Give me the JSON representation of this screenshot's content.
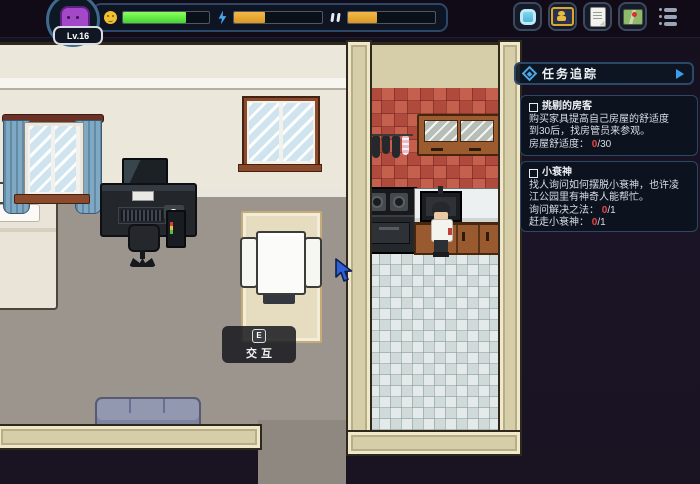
{
  "hud": {
    "avatar": {
      "level_label": "Lv.16"
    },
    "bars": {
      "mood": {
        "icon": "smiley-icon",
        "percent": 73,
        "fill": "#58da3a"
      },
      "energy": {
        "icon": "lightning-icon",
        "percent": 35,
        "fill": "#e8a832"
      },
      "social": {
        "icon": "double-mark-icon",
        "percent": 33,
        "fill": "#e8a832"
      }
    },
    "menu_buttons": [
      {
        "icon": "bag-icon"
      },
      {
        "icon": "character-card-icon"
      },
      {
        "icon": "scroll-icon"
      },
      {
        "icon": "map-icon"
      },
      {
        "icon": "menu-list-icon"
      }
    ]
  },
  "quest_panel": {
    "title": "任务追踪",
    "expand_icon": "right-triangle",
    "bullet_icon": "diamond",
    "quests": [
      {
        "title": "挑剔的房客",
        "desc_line1": "购买家具提高自己房屋的舒适度",
        "desc_line2": "到30后，找房管员来参观。",
        "progress": [
          {
            "label": "房屋舒适度：",
            "value": "0",
            "total": "/30"
          }
        ]
      },
      {
        "title": "小衰神",
        "desc_line1": "找人询问如何摆脱小衰神，也许凌",
        "desc_line2": "江公园里有神奇人能帮忙。",
        "progress": [
          {
            "label": "询问解决之法：",
            "value": "0",
            "total": "/1"
          },
          {
            "label": "赶走小衰神：",
            "value": "0",
            "total": "/1"
          }
        ]
      }
    ]
  },
  "interaction_prompt": {
    "key": "E",
    "label": "交互"
  },
  "colors": {
    "bar_green": "#58da3a",
    "bar_orange": "#e8a832",
    "panel_border": "#2c4868",
    "quest_value_red": "#e84545",
    "wall_cream": "#ebe7da",
    "floor_gray": "#9c958e",
    "brick_red": "#bd5546",
    "tile_white": "#dce3e2",
    "band_tan": "#d6cda9",
    "outside_dark": "#1a1322",
    "cursor_blue": "#2e5fd8"
  }
}
